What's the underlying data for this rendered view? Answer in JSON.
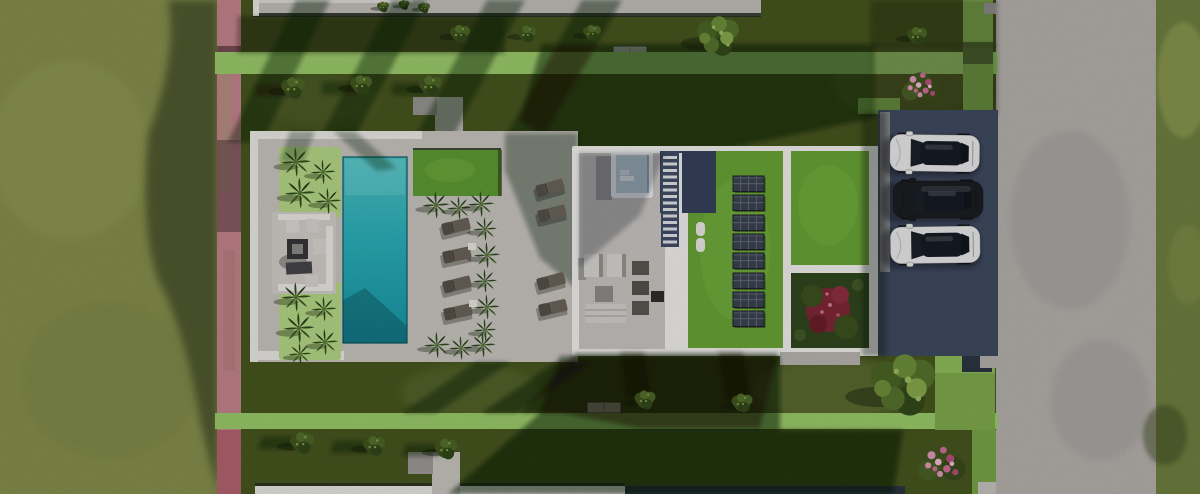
{
  "scene": {
    "description": "Aerial top-down 3D architectural rendering of a modern flat-roof villa plot between neighbouring villas: meadow on the left, flower hedge boundary, pool terrace with palms and loungers, villa roof with skylight, stair void, green roofs with solar panels and a roof garden, three parked cars beside a road on the right.",
    "inventory": {
      "swimming_pools": 1,
      "solar_panel_rows": 8,
      "sun_loungers_pool_side": 4,
      "sun_loungers_house_side": 4,
      "parked_cars": [
        "white car",
        "black car",
        "white car"
      ],
      "pergola_lawn_canopies": 1,
      "skylights": 1,
      "staircases": 1,
      "flower_bushes": 2,
      "garden_gates": 2,
      "neighbour_roofs_visible": 2
    }
  },
  "colors": {
    "field": "#87904e",
    "field_shadow": "#3f4a26",
    "lawn": "#47561f",
    "lawn_light": "#5a6a30",
    "hedge_bright": "#9ccb6b",
    "flower_hedge_pink": "#c5858d",
    "paving": "#c9c6c1",
    "paving_white": "#eceae6",
    "pool_light": "#4cc3c6",
    "pool_deep": "#1796a5",
    "pergola_grass": "#5f9b33",
    "palm_ground": "#b7d888",
    "palm_frond": "#2f4a1d",
    "house_parapet": "#f2f1ee",
    "roof_terrace": "#c8c5c1",
    "green_roof": "#6aa437",
    "solar_panel": "#3d4450",
    "void_dark": "#36415a",
    "road": "#b6b2ae",
    "roadside_grass": "#6f8040",
    "parking": "#3f4a60",
    "car_white": "#e9e9eb",
    "car_black": "#1c1d22",
    "car_glass": "#161b24",
    "flower_pink": "#cf6f9a",
    "tree_green": "#6d8f3a",
    "shadow": "#0c1308"
  }
}
